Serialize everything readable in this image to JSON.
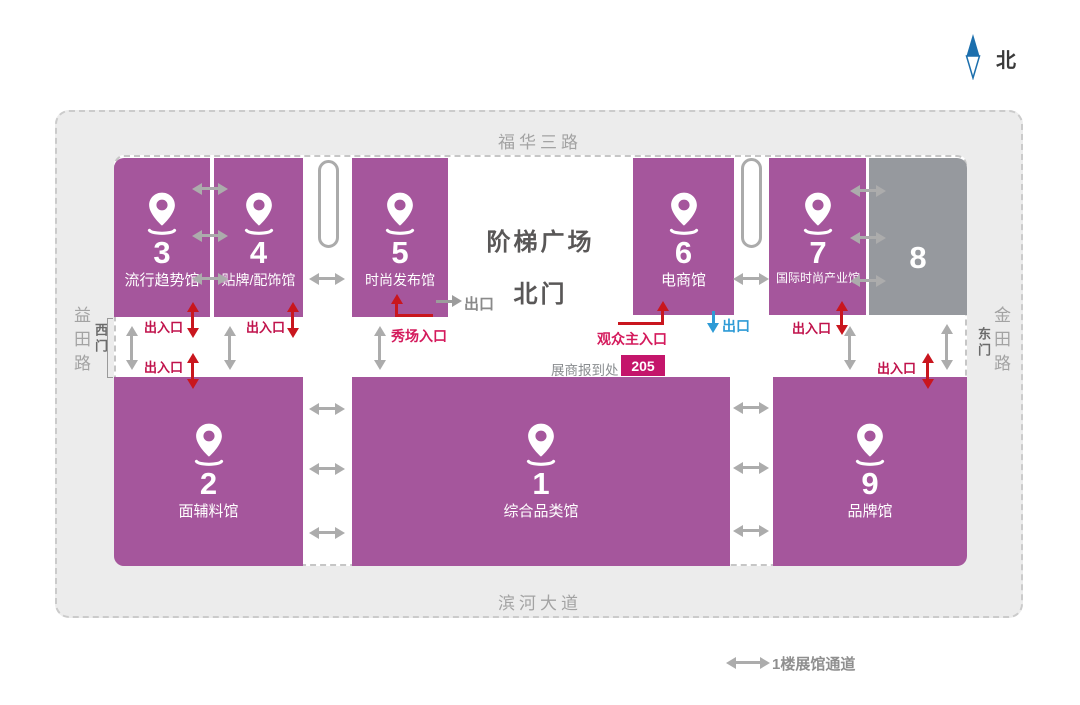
{
  "compass": {
    "label": "北"
  },
  "roads": {
    "top": "福华三路",
    "bottom": "滨河大道",
    "left": "益田路",
    "right": "金田路"
  },
  "gates": {
    "west": "西门",
    "east": "东门"
  },
  "plaza": {
    "title": "阶梯广场",
    "north_gate": "北门"
  },
  "halls": {
    "h3": {
      "number": "3",
      "name": "流行趋势馆"
    },
    "h4": {
      "number": "4",
      "name": "贴牌/配饰馆"
    },
    "h5": {
      "number": "5",
      "name": "时尚发布馆"
    },
    "h6": {
      "number": "6",
      "name": "电商馆"
    },
    "h7": {
      "number": "7",
      "name": "国际时尚产业馆"
    },
    "h8": {
      "number": "8"
    },
    "h2": {
      "number": "2",
      "name": "面辅料馆"
    },
    "h1": {
      "number": "1",
      "name": "综合品类馆"
    },
    "h9": {
      "number": "9",
      "name": "品牌馆"
    }
  },
  "labels": {
    "entrance_exit": "出入口",
    "show_entrance": "秀场入口",
    "audience_main_entrance": "观众主入口",
    "exit": "出口",
    "exhibitor_checkin": "展商报到处",
    "checkin_room": "205"
  },
  "legend": {
    "passage": "1楼展馆通道"
  },
  "colors": {
    "hall_purple": "#A5569C",
    "hall_gray": "#96999E",
    "red_arrow": "#C9161E",
    "entrance_text": "#C0124B",
    "main_entrance_text": "#D41A5C",
    "exit_blue": "#2E9BD6",
    "checkin_badge": "#C4156B",
    "compass_blue": "#1C6FAD",
    "passage_arrow": "#ACACAC"
  }
}
